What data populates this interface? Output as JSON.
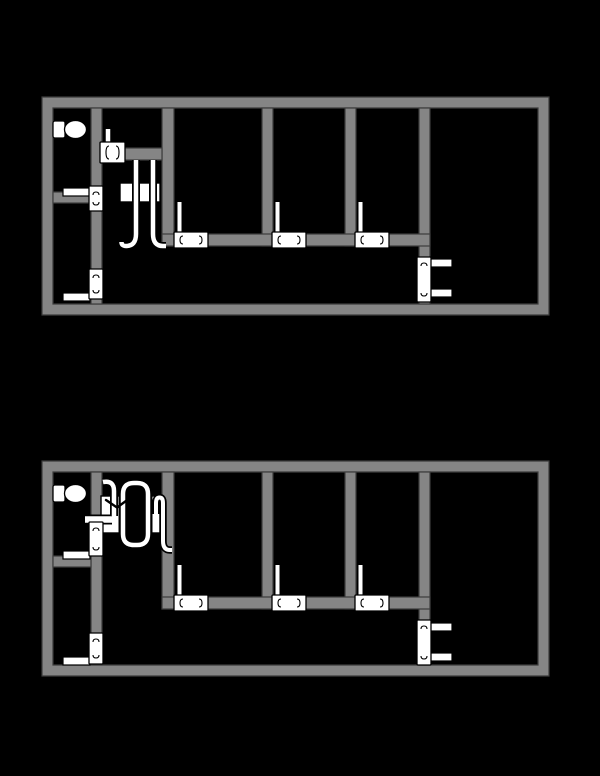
{
  "canvas": {
    "width": 600,
    "height": 776,
    "background": "#000000"
  },
  "palette": {
    "wall_fill": "#858585",
    "wall_edge": "#3c3c3c",
    "fixture_fill": "#ffffff",
    "line": "#000000"
  },
  "plans": [
    {
      "name": "floor-plan-top",
      "frame": {
        "outer": [
          42,
          97,
          549,
          315
        ],
        "inner": [
          53,
          108,
          538,
          304
        ]
      },
      "walls": [
        {
          "name": "bathroom-wall-vertical",
          "r": [
            91,
            108,
            11,
            196
          ]
        },
        {
          "name": "bathroom-wall-horizontal",
          "r": [
            53,
            192,
            38,
            11
          ]
        },
        {
          "name": "partition-wall-1",
          "r": [
            162,
            108,
            12,
            138
          ]
        },
        {
          "name": "partition-wall-2",
          "r": [
            262,
            108,
            11,
            138
          ]
        },
        {
          "name": "partition-wall-3",
          "r": [
            345,
            108,
            11,
            138
          ]
        },
        {
          "name": "partition-wall-4",
          "r": [
            419,
            108,
            11,
            196
          ]
        },
        {
          "name": "corridor-wall",
          "r": [
            162,
            234,
            268,
            12
          ]
        },
        {
          "name": "boiler-branch-wall",
          "r": [
            102,
            148,
            60,
            12
          ]
        }
      ],
      "bars": [
        {
          "name": "bathroom-baseboard",
          "r": [
            63,
            188,
            27,
            8
          ]
        },
        {
          "name": "lower-room-baseboard",
          "r": [
            63,
            293,
            27,
            8
          ]
        },
        {
          "name": "right-room-stub-upper",
          "r": [
            430,
            259,
            22,
            8
          ]
        },
        {
          "name": "right-room-stub-lower",
          "r": [
            430,
            289,
            22,
            8
          ]
        }
      ],
      "toilet": {
        "tank": [
          53,
          121,
          12,
          17
        ],
        "bowl": [
          75.5,
          129.5,
          11,
          9
        ]
      },
      "boiler_box": [
        120,
        183,
        40,
        19
      ],
      "racetrack": null,
      "chevron": null,
      "units": [
        {
          "name": "doorway-upper",
          "r": [
            89,
            186,
            14,
            25
          ],
          "o": "v"
        },
        {
          "name": "doorway-lower",
          "r": [
            89,
            269,
            14,
            30
          ],
          "o": "v"
        },
        {
          "name": "branch-inlet-fixture",
          "r": [
            100,
            142,
            25,
            21
          ],
          "o": "h"
        },
        {
          "name": "corridor-radiator-1",
          "r": [
            174,
            232,
            34,
            16
          ],
          "o": "h"
        },
        {
          "name": "corridor-radiator-2",
          "r": [
            272,
            232,
            34,
            16
          ],
          "o": "h"
        },
        {
          "name": "corridor-radiator-3",
          "r": [
            355,
            232,
            34,
            16
          ],
          "o": "h"
        },
        {
          "name": "right-room-radiator",
          "r": [
            417,
            257,
            14,
            45
          ],
          "o": "v"
        }
      ],
      "pipes": [
        {
          "name": "bathroom-riser-pipe",
          "d": "M 108,145 V 129",
          "pw": 8,
          "iw": 4.5
        },
        {
          "name": "supply-pipe",
          "d": "M 136,160 V 234 Q 136,246 126,246 Q 121.5,246 121.5,242",
          "pw": 8,
          "iw": 4.5
        },
        {
          "name": "return-pipe",
          "d": "M 153,160 V 234 Q 153,246 163,246 L 166,246",
          "pw": 8,
          "iw": 4.5
        },
        {
          "name": "radiator-riser-1",
          "d": "M 179.5,232 V 202",
          "pw": 7,
          "iw": 4
        },
        {
          "name": "radiator-riser-2",
          "d": "M 277.5,232 V 202",
          "pw": 7,
          "iw": 4
        },
        {
          "name": "radiator-riser-3",
          "d": "M 360.5,232 V 202",
          "pw": 7,
          "iw": 4
        }
      ]
    },
    {
      "name": "floor-plan-bottom",
      "frame": {
        "outer": [
          42,
          461,
          549,
          676
        ],
        "inner": [
          53,
          472,
          538,
          665
        ]
      },
      "walls": [
        {
          "name": "bathroom-wall-vertical",
          "r": [
            91,
            472,
            11,
            193
          ]
        },
        {
          "name": "bathroom-wall-horizontal",
          "r": [
            53,
            556,
            38,
            11
          ]
        },
        {
          "name": "partition-wall-1",
          "r": [
            162,
            472,
            12,
            137
          ]
        },
        {
          "name": "partition-wall-2",
          "r": [
            262,
            472,
            11,
            137
          ]
        },
        {
          "name": "partition-wall-3",
          "r": [
            345,
            472,
            11,
            137
          ]
        },
        {
          "name": "partition-wall-4",
          "r": [
            419,
            472,
            11,
            193
          ]
        },
        {
          "name": "corridor-wall",
          "r": [
            162,
            597,
            268,
            12
          ]
        }
      ],
      "bars": [
        {
          "name": "bathroom-baseboard",
          "r": [
            63,
            551,
            27,
            8
          ]
        },
        {
          "name": "lower-room-baseboard",
          "r": [
            63,
            657,
            27,
            8
          ]
        },
        {
          "name": "right-room-stub-upper",
          "r": [
            430,
            623,
            22,
            8
          ]
        },
        {
          "name": "right-room-stub-lower",
          "r": [
            430,
            653,
            22,
            8
          ]
        }
      ],
      "toilet": {
        "tank": [
          53,
          485,
          12,
          17
        ],
        "bowl": [
          75.5,
          493.5,
          11,
          9
        ]
      },
      "boiler_box": [
        101,
        496,
        62,
        37
      ],
      "racetrack": {
        "d": "M 134,483 H 137 Q 148,483 148,494 V 534 Q 148,545 137,545 H 134 Q 123,545 123,534 V 494 Q 123,483 134,483 Z",
        "pw": 9,
        "iw": 4.5
      },
      "chevron": {
        "d": "M 106,500 L 117,507.5 L 128,499.5",
        "w": 2.4
      },
      "units": [
        {
          "name": "doorway-upper",
          "r": [
            89,
            522,
            14,
            34
          ],
          "o": "v"
        },
        {
          "name": "doorway-lower",
          "r": [
            89,
            633,
            14,
            31
          ],
          "o": "v"
        },
        {
          "name": "corridor-radiator-1",
          "r": [
            174,
            595,
            34,
            16
          ],
          "o": "h"
        },
        {
          "name": "corridor-radiator-2",
          "r": [
            272,
            595,
            34,
            16
          ],
          "o": "h"
        },
        {
          "name": "corridor-radiator-3",
          "r": [
            355,
            595,
            34,
            16
          ],
          "o": "h"
        },
        {
          "name": "right-room-radiator",
          "r": [
            417,
            620,
            14,
            45
          ],
          "o": "v"
        }
      ],
      "pipes": [
        {
          "name": "wall-crossing-stub",
          "d": "M 85,519.5 H 112",
          "pw": 10,
          "iw": 6.5
        },
        {
          "name": "inlet-elbow-pipe",
          "d": "M 103,482 Q 114,480 114,491 V 516",
          "pw": 8,
          "iw": 4.5
        },
        {
          "name": "loop-riser-return",
          "d": "M 156,514 V 503 Q 156,497.5 159.5,497.5 Q 163,497.5 163,503 V 541 Q 163,550 170,550 L 172,550",
          "pw": 7.5,
          "iw": 4
        },
        {
          "name": "radiator-riser-1",
          "d": "M 179.5,595 V 565",
          "pw": 7,
          "iw": 4
        },
        {
          "name": "radiator-riser-2",
          "d": "M 277.5,595 V 565",
          "pw": 7,
          "iw": 4
        },
        {
          "name": "radiator-riser-3",
          "d": "M 360.5,595 V 565",
          "pw": 7,
          "iw": 4
        }
      ]
    }
  ]
}
